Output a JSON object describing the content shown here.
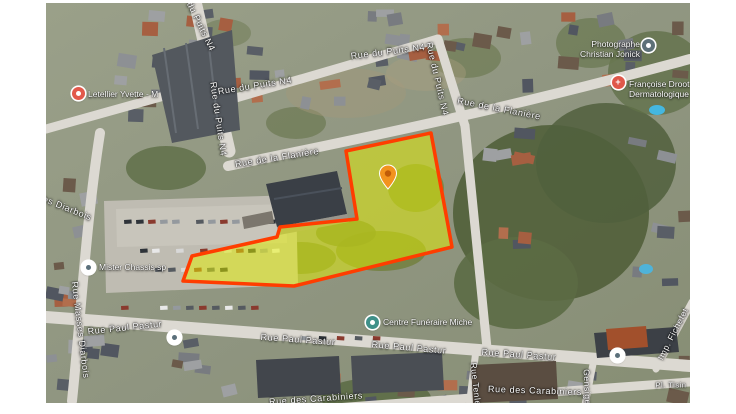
{
  "map": {
    "left": 46,
    "top": 3,
    "width": 644,
    "height": 400,
    "street_labels": [
      {
        "text": "Rue du Puits N4",
        "x": 150,
        "y": 14,
        "rot": 64
      },
      {
        "text": "Rue du Puits N4",
        "x": 172,
        "y": 116,
        "rot": 82
      },
      {
        "text": "Rue du Puits N4",
        "x": 209,
        "y": 83,
        "rot": -9
      },
      {
        "text": "Rue du Puits N4",
        "x": 342,
        "y": 49,
        "rot": -7
      },
      {
        "text": "Rue du Puits N4",
        "x": 391,
        "y": 76,
        "rot": 77
      },
      {
        "text": "Rue de la Flanière",
        "x": 231,
        "y": 155,
        "rot": -9
      },
      {
        "text": "Rue de la Flanière",
        "x": 453,
        "y": 106,
        "rot": 11
      },
      {
        "text": "Rue Masses Diarbois",
        "x": 0,
        "y": 197,
        "rot": 22
      },
      {
        "text": "Rue Masses Diarbois",
        "x": 34,
        "y": 327,
        "rot": 83
      },
      {
        "text": "Rue Paul Pastur",
        "x": 79,
        "y": 325,
        "rot": -6
      },
      {
        "text": "Rue Paul Pastur",
        "x": 252,
        "y": 337,
        "rot": 4
      },
      {
        "text": "Rue Paul Pastur",
        "x": 363,
        "y": 345,
        "rot": 5
      },
      {
        "text": "Rue Paul Pastur",
        "x": 473,
        "y": 352,
        "rot": 4
      },
      {
        "text": "Rue des Carabiniers",
        "x": 270,
        "y": 396,
        "rot": -4
      },
      {
        "text": "Rue des Carabiniers",
        "x": 489,
        "y": 388,
        "rot": 2
      },
      {
        "text": "Rue Tenlem",
        "x": 430,
        "y": 385,
        "rot": 84,
        "size": 8.5
      },
      {
        "text": "Gensige",
        "x": 541,
        "y": 384,
        "rot": 88,
        "size": 8.5
      },
      {
        "text": "Imp. Fichefet",
        "x": 627,
        "y": 331,
        "rot": -63,
        "size": 8.5
      },
      {
        "text": "Pl. Tisin",
        "x": 625,
        "y": 382,
        "rot": 0,
        "size": 7.5
      }
    ],
    "poi": [
      {
        "id": "letellier",
        "marker": {
          "x": 32,
          "y": 90,
          "bg": "#e2594b",
          "glyph": "dot-white"
        },
        "label": {
          "lines": [
            "Letellier Yvette - M"
          ],
          "x": 42,
          "y": 91,
          "align": "left"
        }
      },
      {
        "id": "photographe",
        "marker": {
          "x": 602,
          "y": 42,
          "bg": "#5d7078",
          "glyph": "dot-white"
        },
        "label": {
          "lines": [
            "Photographe",
            "Christian Jonick"
          ],
          "x": 594,
          "y": 46,
          "align": "right"
        }
      },
      {
        "id": "dermatologue",
        "marker": {
          "x": 572,
          "y": 79,
          "bg": "#df584a",
          "glyph": "cross"
        },
        "label": {
          "lines": [
            "Françoise Droot",
            "Dermatologique"
          ],
          "x": 583,
          "y": 86,
          "align": "left"
        }
      },
      {
        "id": "mister-chassis",
        "marker": {
          "x": 42,
          "y": 264,
          "bg": "#ffffff",
          "glyph": "dot-slate"
        },
        "label": {
          "lines": [
            "Mister Chassis sp"
          ],
          "x": 53,
          "y": 264,
          "align": "left"
        }
      },
      {
        "id": "centre-funeraire",
        "marker": {
          "x": 326,
          "y": 319,
          "bg": "#3f9089",
          "glyph": "dot-white"
        },
        "label": {
          "lines": [
            "Centre Funéraire Miche"
          ],
          "x": 337,
          "y": 319,
          "align": "left"
        }
      },
      {
        "id": "school",
        "marker": {
          "x": 571,
          "y": 352,
          "bg": "#ffffff",
          "glyph": "dot-slate"
        }
      },
      {
        "id": "transit",
        "marker": {
          "x": 128,
          "y": 334,
          "bg": "#ffffff",
          "glyph": "dot-slate"
        }
      }
    ],
    "parcel": {
      "points": "300,148 385,130 406,244 248,283 137,278 146,253 231,234 234,224 311,216",
      "fill": "#e8f400",
      "fill_opacity": 0.5,
      "stroke": "#ff3d00",
      "stroke_width": 3.5
    },
    "pin": {
      "x": 342,
      "y": 171,
      "color": "#f2931e",
      "inner": "#c05c08"
    }
  }
}
